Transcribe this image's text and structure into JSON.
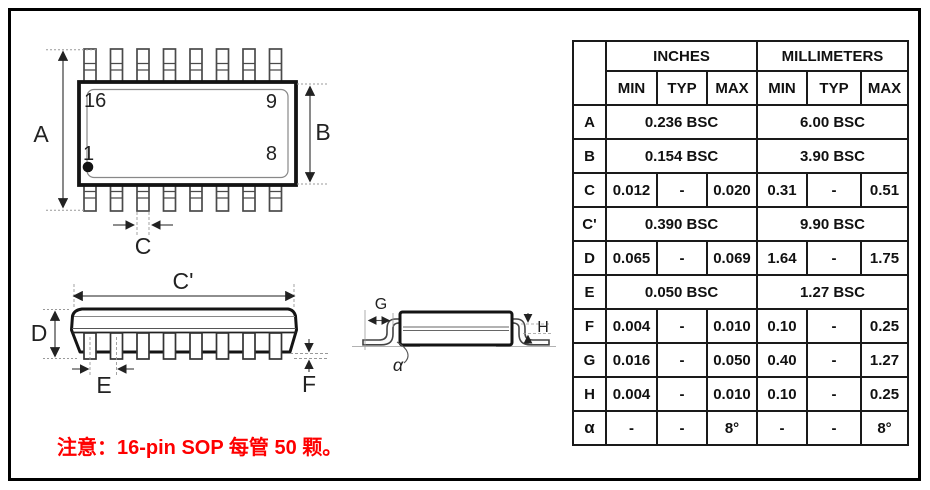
{
  "note": {
    "text": "注意：16-pin SOP 每管 50 颗。",
    "color": "#FE0000"
  },
  "drawing": {
    "top_view": {
      "pin_labels": {
        "top_left": "16",
        "top_right": "9",
        "bottom_left": "1",
        "bottom_right": "8"
      },
      "dims": {
        "a": "A",
        "b": "B",
        "c": "C"
      }
    },
    "front_view": {
      "dims": {
        "c_prime": "C'",
        "d": "D",
        "e": "E",
        "f": "F"
      }
    },
    "side_view": {
      "dims": {
        "g": "G",
        "h": "H",
        "alpha": "α"
      }
    },
    "colors": {
      "outline": "#141414",
      "dimension_line": "#4a4a4a"
    }
  },
  "table": {
    "unit_headers": [
      "INCHES",
      "MILLIMETERS"
    ],
    "col_headers": [
      "MIN",
      "TYP",
      "MAX",
      "MIN",
      "TYP",
      "MAX"
    ],
    "rows": [
      {
        "symbol": "A",
        "cells": [
          "0.236 BSC",
          "6.00 BSC"
        ]
      },
      {
        "symbol": "B",
        "cells": [
          "0.154 BSC",
          "3.90 BSC"
        ]
      },
      {
        "symbol": "C",
        "cells": [
          "0.012",
          "-",
          "0.020",
          "0.31",
          "-",
          "0.51"
        ]
      },
      {
        "symbol": "C'",
        "cells": [
          "0.390 BSC",
          "9.90 BSC"
        ]
      },
      {
        "symbol": "D",
        "cells": [
          "0.065",
          "-",
          "0.069",
          "1.64",
          "-",
          "1.75"
        ]
      },
      {
        "symbol": "E",
        "cells": [
          "0.050 BSC",
          "1.27 BSC"
        ]
      },
      {
        "symbol": "F",
        "cells": [
          "0.004",
          "-",
          "0.010",
          "0.10",
          "-",
          "0.25"
        ]
      },
      {
        "symbol": "G",
        "cells": [
          "0.016",
          "-",
          "0.050",
          "0.40",
          "-",
          "1.27"
        ]
      },
      {
        "symbol": "H",
        "cells": [
          "0.004",
          "-",
          "0.010",
          "0.10",
          "-",
          "0.25"
        ]
      },
      {
        "symbol": "α",
        "cells": [
          "-",
          "-",
          "8°",
          "-",
          "-",
          "8°"
        ]
      }
    ],
    "colors": {
      "border": "#1a1a1a",
      "text": "#111111"
    }
  }
}
